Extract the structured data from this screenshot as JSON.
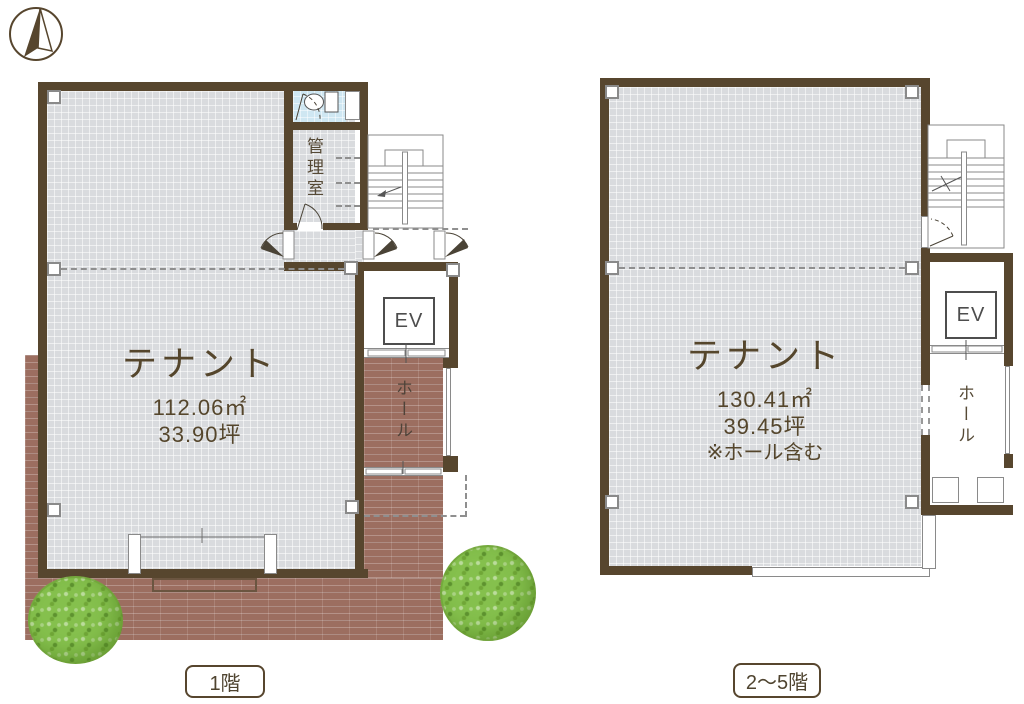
{
  "page": {
    "type": "building-floor-plan",
    "background": "#ffffff"
  },
  "colors": {
    "wall": "#57462e",
    "floor_gray": "#d9dbde",
    "brick": "#9c6e60",
    "toilet_blue": "#cfe7f2",
    "tree_green": "#85c04d",
    "text_brown": "#55462c",
    "line_gray": "#777777"
  },
  "compass": {
    "icon": "north-arrow-compass"
  },
  "plans": {
    "f1": {
      "caption": "1階",
      "tenant_label": "テナント",
      "area_m2": "112.06㎡",
      "area_tsubo": "33.90坪",
      "office_label": "管理室",
      "hall_label": "ホール",
      "elevator_label": "EV",
      "stairs_up": "UP"
    },
    "f25": {
      "caption": "2〜5階",
      "tenant_label": "テナント",
      "area_m2": "130.41㎡",
      "area_tsubo": "39.45坪",
      "note": "※ホール含む",
      "hall_label": "ホール",
      "elevator_label": "EV",
      "stairs_down": "DW",
      "stairs_up": "UP"
    }
  }
}
